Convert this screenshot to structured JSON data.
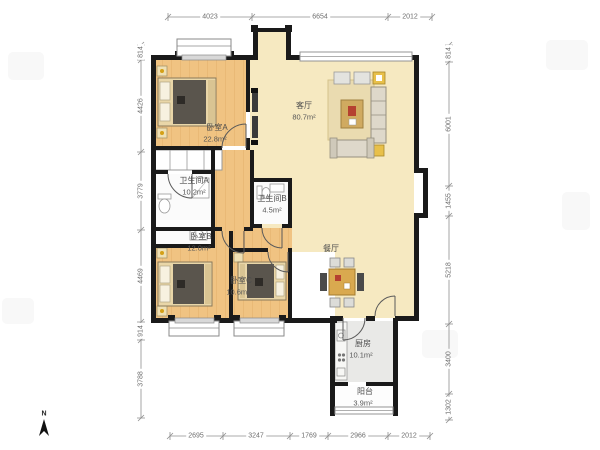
{
  "plan": {
    "title": "apartment-floor-plan",
    "rooms": [
      {
        "id": "bedroom-a",
        "name": "卧室A",
        "area": "22.8m²"
      },
      {
        "id": "living-room",
        "name": "客厅",
        "area": "80.7m²"
      },
      {
        "id": "bathroom-a",
        "name": "卫生间A",
        "area": "10.2m²"
      },
      {
        "id": "bathroom-b",
        "name": "卫生间B",
        "area": "4.5m²"
      },
      {
        "id": "bedroom-b",
        "name": "卧室B",
        "area": "12.0m²"
      },
      {
        "id": "bedroom-c",
        "name": "卧室C",
        "area": "10.6m²"
      },
      {
        "id": "dining-room",
        "name": "餐厅",
        "area": ""
      },
      {
        "id": "kitchen",
        "name": "厨房",
        "area": "10.1m²"
      },
      {
        "id": "balcony",
        "name": "阳台",
        "area": "3.9m²"
      }
    ],
    "dimensions": {
      "top": [
        "4023",
        "6654",
        "2012"
      ],
      "bottom": [
        "2695",
        "3247",
        "1769",
        "2966",
        "2012"
      ],
      "left": [
        "814",
        "4426",
        "3779",
        "4469",
        "914",
        "3788"
      ],
      "right": [
        "814",
        "6001",
        "1455",
        "5218",
        "3400",
        "1302"
      ]
    },
    "compass": {
      "label": "N"
    },
    "colors": {
      "wall": "#1a1a1a",
      "wood_floor": "#f0c382",
      "living_floor": "#f6e9c1",
      "wet_room_floor": "#fbfbfb",
      "kitchen_floor": "#e9e9e7",
      "accent_yellow": "#e8c04a",
      "blanket_gray": "#5a554d",
      "dim_text": "#6e6e6e"
    }
  }
}
